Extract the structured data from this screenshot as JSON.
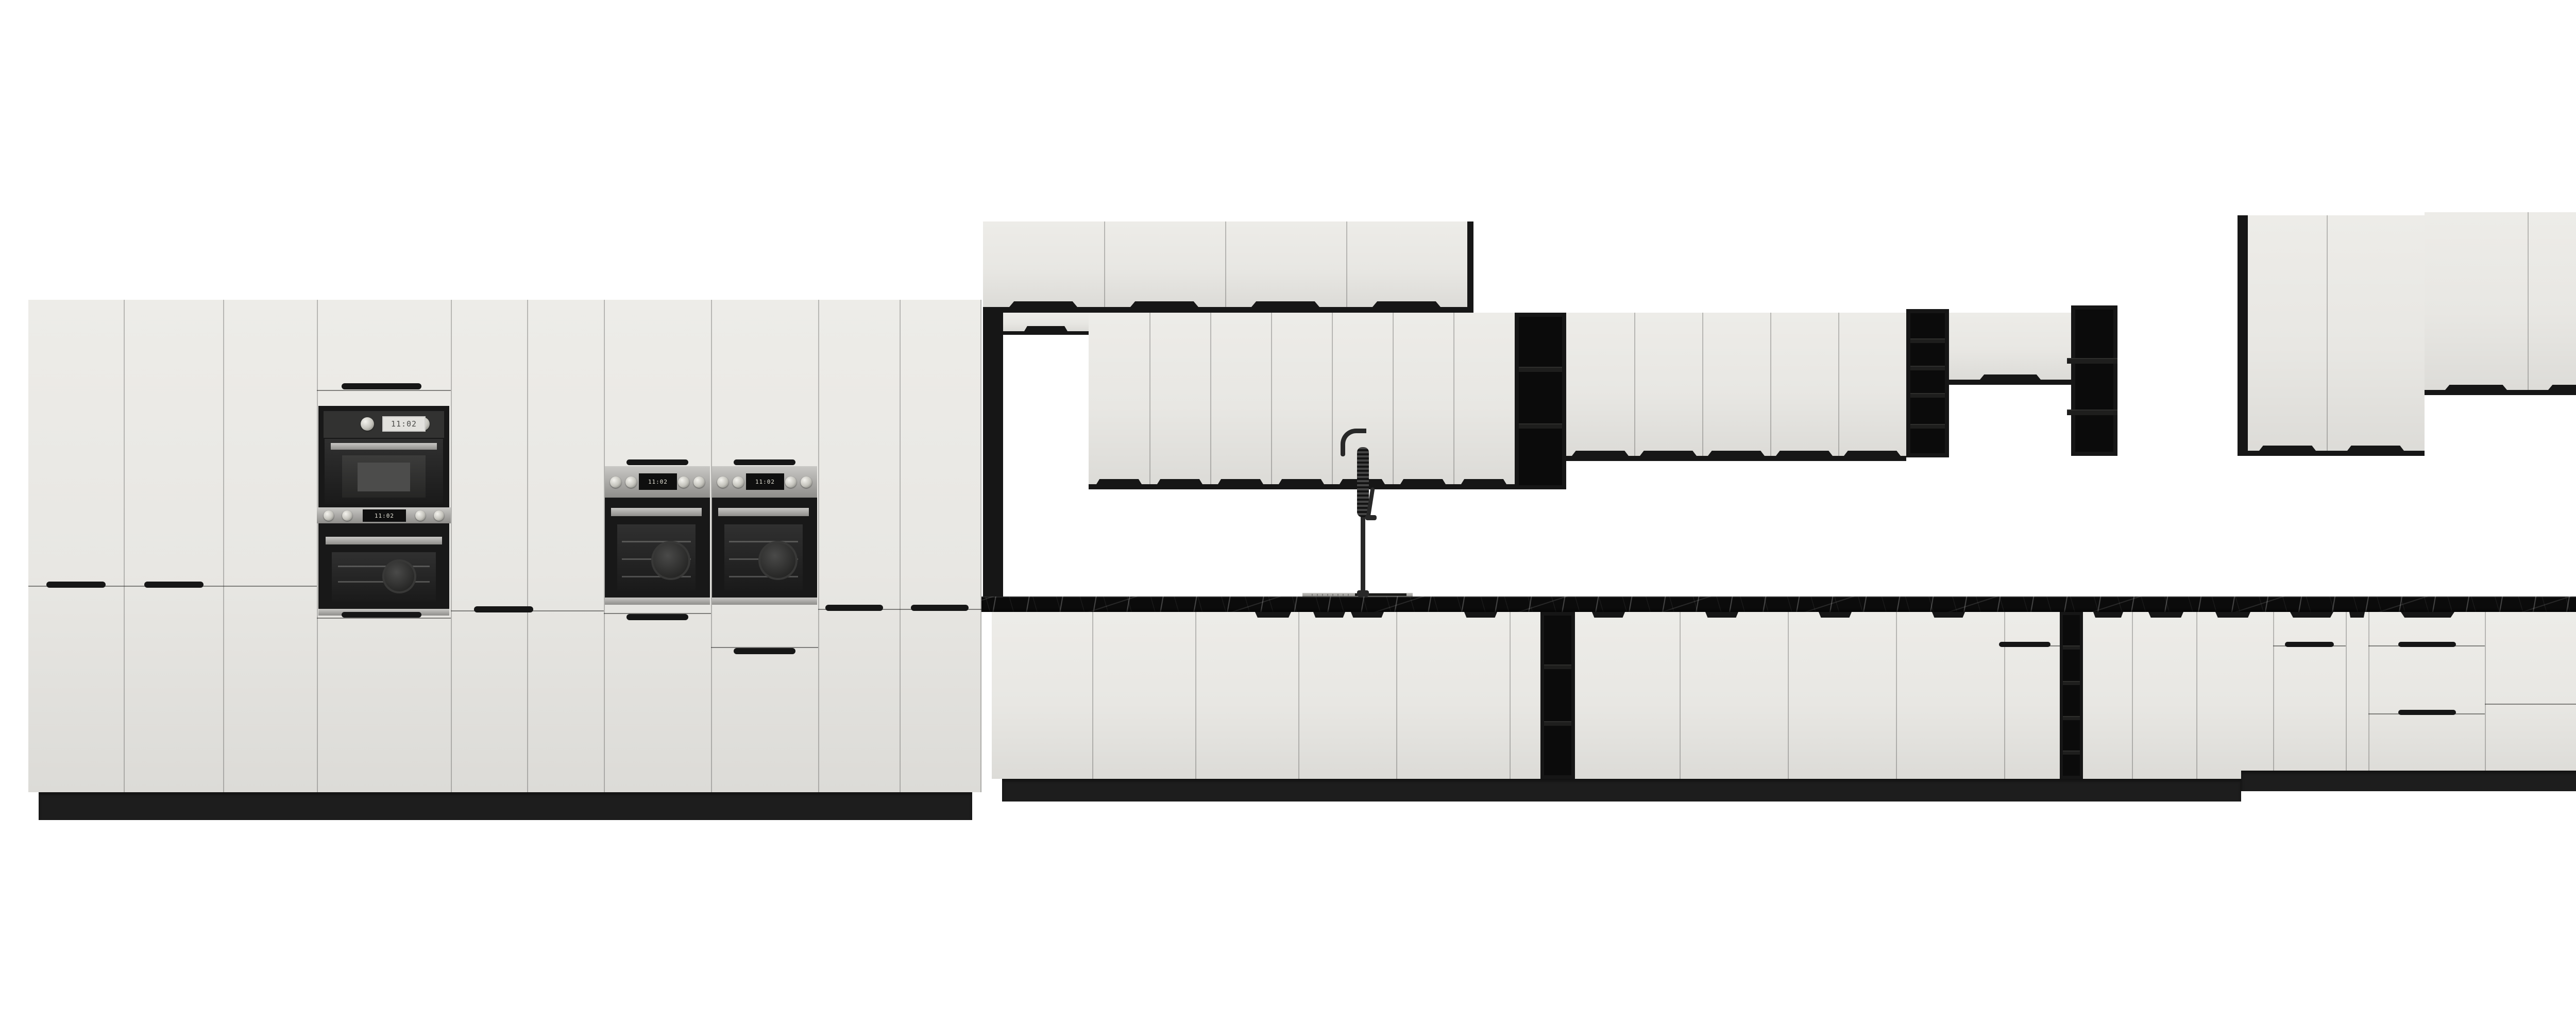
{
  "meta": {
    "scene_title": "Kitchen cabinetry elevation render"
  },
  "palette": {
    "bg": "#ffffff",
    "face": "#e8e7e3",
    "face_light": "#edece8",
    "face_dark": "#dcdbd7",
    "black": "#161616",
    "shelf_int": "#0b0b0b",
    "shelf_board": "#1e1e1d",
    "counter": "#0b0b0b",
    "plinth": "#1d1d1d",
    "appl": "#181818",
    "faucet": "#282828"
  },
  "appliances": {
    "clock_time": "11:02",
    "microwave_label": "built-in-microwave",
    "oven_count": 4,
    "dishwasher_label": "semi-integrated-dishwasher-open",
    "faucet_label": "black-spring-gooseneck-mixer",
    "sink_label": "inset-sink-with-drainer"
  },
  "scene": {
    "sections": [
      "tall-cabinet-run-left",
      "appliance-tower-microwave-oven",
      "double-wall-ovens",
      "top-wall-cabinet-row",
      "sink-wall-cabinet-row",
      "black-open-shelf-units",
      "sink-and-faucet",
      "base-cabinet-run",
      "dishwasher-and-oven-right",
      "tall-black-shelf-unit-right"
    ]
  }
}
